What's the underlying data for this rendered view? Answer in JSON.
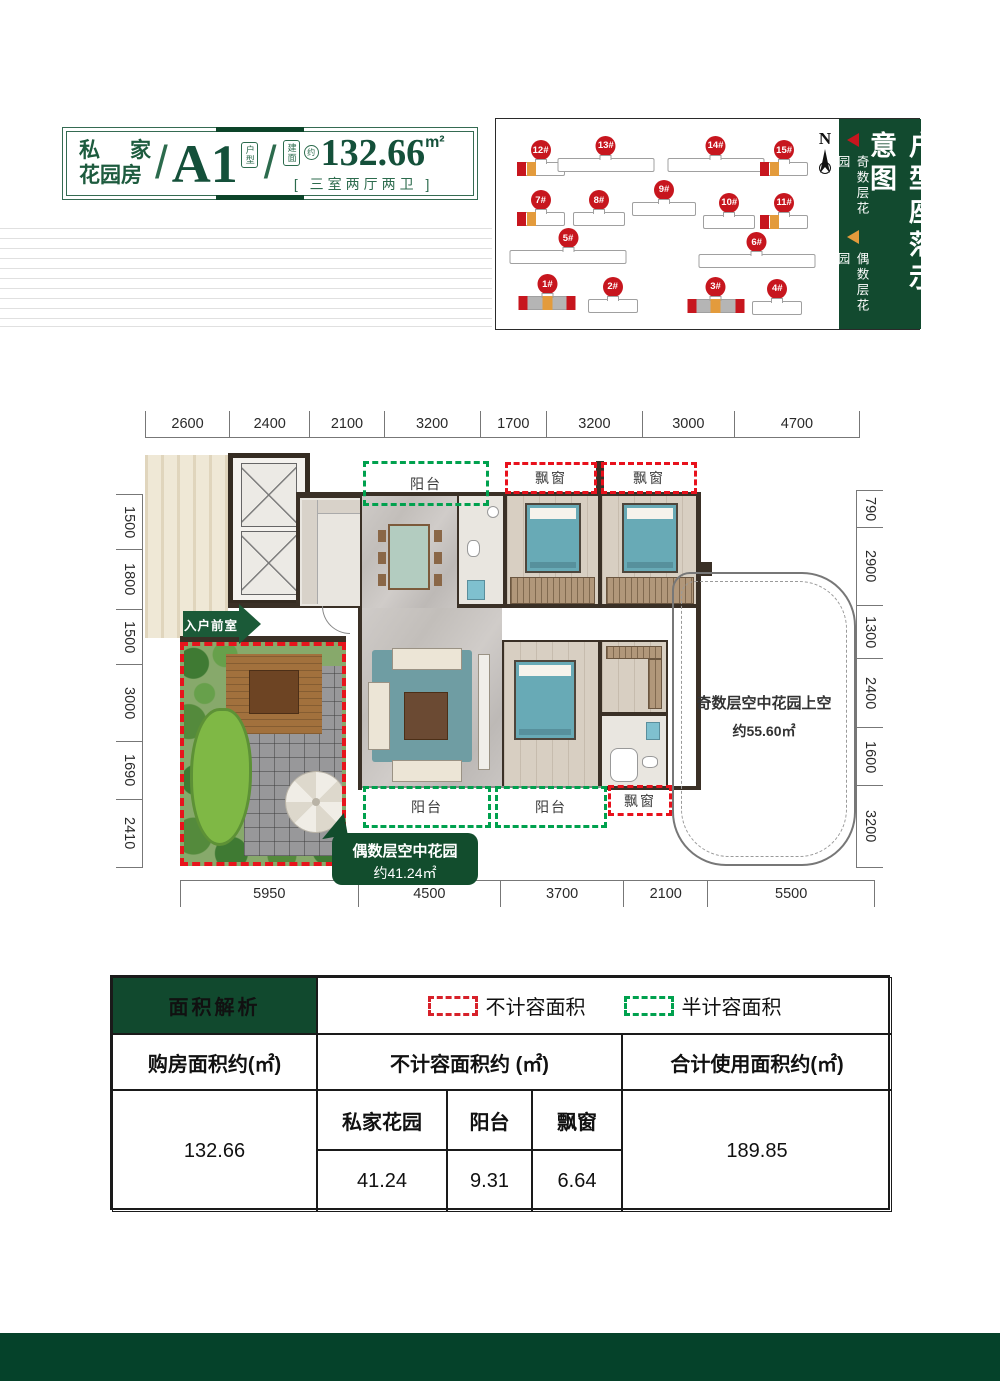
{
  "header": {
    "title_line1_a": "私",
    "title_line1_b": "家",
    "title_line2": "花园房",
    "slash": "/",
    "unit_code": "A1",
    "unit_seal": "户型",
    "area_seal": "建面",
    "approx_mark": "约",
    "area_value": "132.66",
    "area_unit": "m²",
    "layout_desc": "[ 三室两厅两卫 ]"
  },
  "siteplan": {
    "compass": "N",
    "sidebar_title": "户型座落示意图",
    "legend": [
      {
        "label": "奇数层花园",
        "color": "#c7161e"
      },
      {
        "label": "偶数层花园",
        "color": "#e39b3c"
      }
    ],
    "buildings": [
      {
        "id": "12#",
        "x": 13,
        "y": 10,
        "w": 46,
        "hl": "ro"
      },
      {
        "id": "13#",
        "x": 32,
        "y": 8,
        "w": 95
      },
      {
        "id": "14#",
        "x": 64,
        "y": 8,
        "w": 95
      },
      {
        "id": "15#",
        "x": 84,
        "y": 10,
        "w": 46,
        "hl": "ro"
      },
      {
        "id": "7#",
        "x": 13,
        "y": 34,
        "w": 46,
        "hl": "ro"
      },
      {
        "id": "8#",
        "x": 30,
        "y": 34,
        "w": 50
      },
      {
        "id": "9#",
        "x": 49,
        "y": 29,
        "w": 62
      },
      {
        "id": "10#",
        "x": 68,
        "y": 35,
        "w": 50
      },
      {
        "id": "11#",
        "x": 84,
        "y": 35,
        "w": 46,
        "hl": "ro"
      },
      {
        "id": "5#",
        "x": 21,
        "y": 52,
        "w": 115
      },
      {
        "id": "6#",
        "x": 76,
        "y": 54,
        "w": 115
      },
      {
        "id": "1#",
        "x": 15,
        "y": 74,
        "w": 55,
        "hl": "s"
      },
      {
        "id": "2#",
        "x": 34,
        "y": 75,
        "w": 48
      },
      {
        "id": "3#",
        "x": 64,
        "y": 75,
        "w": 55,
        "hl": "s"
      },
      {
        "id": "4#",
        "x": 82,
        "y": 76,
        "w": 48
      }
    ]
  },
  "floorplan": {
    "dims_top": [
      "2600",
      "2400",
      "2100",
      "3200",
      "1700",
      "3200",
      "3000",
      "4700"
    ],
    "dims_left": [
      "1500",
      "1800",
      "1500",
      "3000",
      "1690",
      "2410"
    ],
    "dims_right": [
      "790",
      "2900",
      "1300",
      "2400",
      "1600",
      "3200"
    ],
    "dims_bottom": [
      "5950",
      "4500",
      "3700",
      "2100",
      "5500"
    ],
    "balcony_top": "阳台",
    "bay_top_1": "飘窗",
    "bay_top_2": "飘窗",
    "entry_label": "入户前室",
    "balcony_bottom_1": "阳台",
    "balcony_bottom_2": "阳台",
    "bay_bottom": "飘窗",
    "void_line1": "奇数层空中花园上空",
    "void_line2": "约55.60㎡",
    "even_garden_line1": "偶数层空中花园",
    "even_garden_line2": "约41.24㎡"
  },
  "area_table": {
    "title": "面积解析",
    "legend_red": "不计容面积",
    "legend_green": "半计容面积",
    "h_purchase": "购房面积约(㎡)",
    "h_noncount": "不计容面积约 (㎡)",
    "h_total": "合计使用面积约(㎡)",
    "purchase_value": "132.66",
    "sub_headers": [
      "私家花园",
      "阳台",
      "飘窗"
    ],
    "sub_values": [
      "41.24",
      "9.31",
      "6.64"
    ],
    "total_value": "189.85"
  },
  "colors": {
    "dark_green": "#0c4429",
    "sidebar_green": "#124a2f",
    "badge_red": "#c7161e",
    "legend_orange": "#e39b3c",
    "dash_red": "#e8111c",
    "dash_green": "#00a14e",
    "total_red": "#d9252b"
  }
}
